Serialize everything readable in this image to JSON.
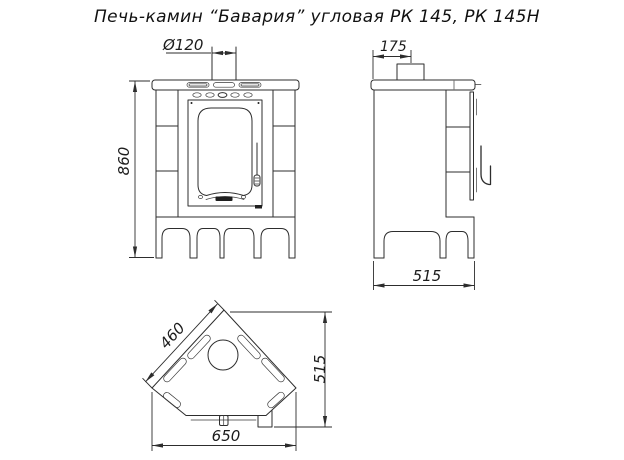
{
  "title": "Печь-камин “Бавария” угловая РК 145, РК 145Н",
  "dimensions": {
    "front": {
      "chimney_diameter": "Ø120",
      "height": "860"
    },
    "side": {
      "flue_offset": "175",
      "depth": "515"
    },
    "top": {
      "side_width": "460",
      "depth": "515",
      "width": "650"
    }
  }
}
